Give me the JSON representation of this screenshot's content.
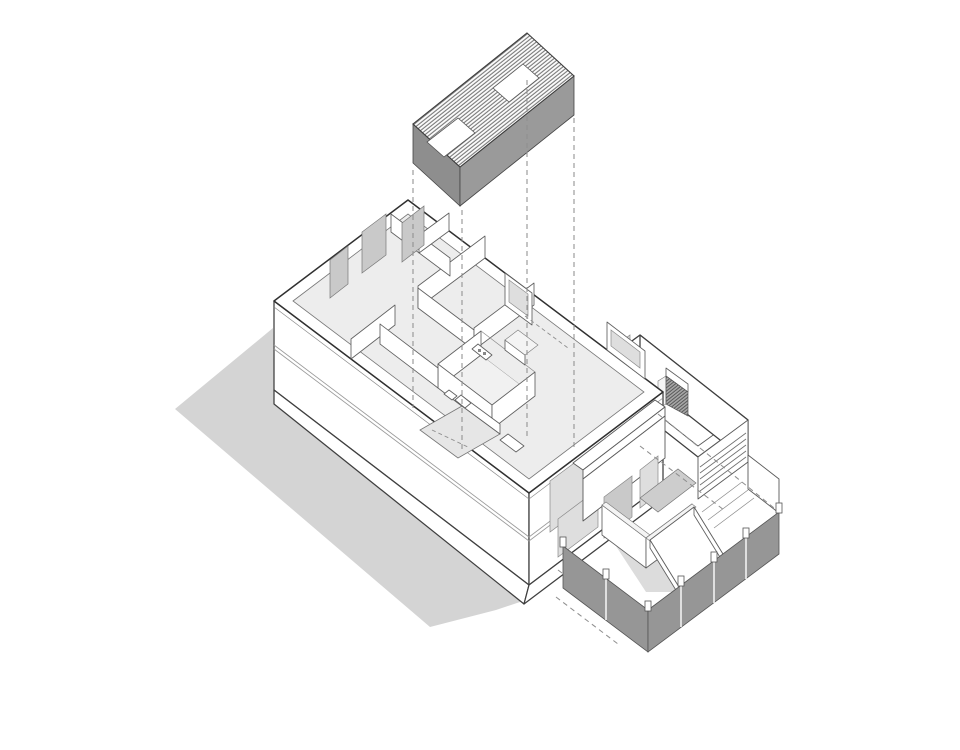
{
  "diagram": {
    "kind": "axonometric-exploded-architectural-drawing",
    "subject": "Two-storey house: hatched roof plane lifted above the first-floor plan, side annex with roof deck and louvers, entry porch with ramp, rear terrace enclosed by a grey panel fence, and a cast shadow on the ground",
    "visible_text": "none",
    "background": "#ffffff"
  },
  "colors": {
    "outline": "#3f3f3f",
    "shadow": "#d4d4d4",
    "floor": "#ededed",
    "room_floor": "#f1f1f1",
    "void_floor": "#e6e6e6",
    "deck": "#f7f7f7",
    "glass": "#dedede",
    "door": "#c9c9c9",
    "roof_fascia_sw": "#8e8e8e",
    "roof_fascia_se": "#9a9a9a",
    "fence": "#969696",
    "landing": "#cdcdcd",
    "ramp_shade": "#dcdcdc",
    "wall_top": "#f4f4f4",
    "dash": "#8f8f8f",
    "hatch_line": "#707070",
    "court_hatch_bg": "#a8a8a8"
  },
  "counts": {
    "roof_skylights": 2,
    "roof_projection_lines": 4,
    "skylight_projection_segments": 2,
    "fence_panels_right_run": 4,
    "fence_panels_left_run": 2,
    "fence_posts": 7,
    "facade_windows": 3,
    "louver_slats": 5,
    "interior_door_leaves": 3,
    "terrace_dashed_lines": 4,
    "facade_band_lines": 2
  }
}
